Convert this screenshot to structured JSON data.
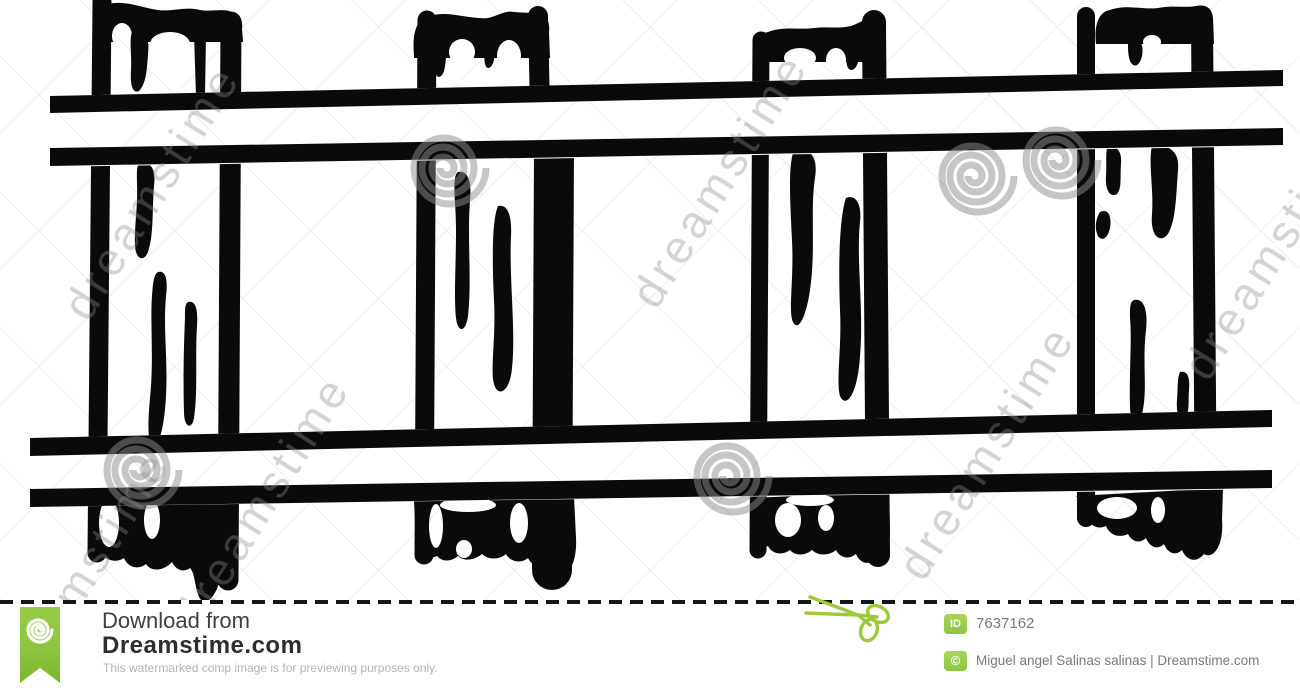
{
  "illustration": {
    "subject": "Black and white hand-drawn clip art of railroad tracks seen from above: two rails crossing four wooden ties with wood-grain marks",
    "ink_color": "#0a0a0a",
    "ties_count": "4",
    "rails_count": "2"
  },
  "watermark": {
    "brand_text": "dreamstime",
    "spiral_color": "#8c8c8c"
  },
  "footer": {
    "download_label": "Download from",
    "site_name": "Dreamstime.com",
    "disclaimer": "This watermarked comp image is for previewing purposes only.",
    "id_badge_label": "ID",
    "image_id": "7637162",
    "copyright_symbol": "©",
    "credit": "Miguel angel Salinas salinas | Dreamstime.com",
    "accent_green": "#8dc63f"
  }
}
